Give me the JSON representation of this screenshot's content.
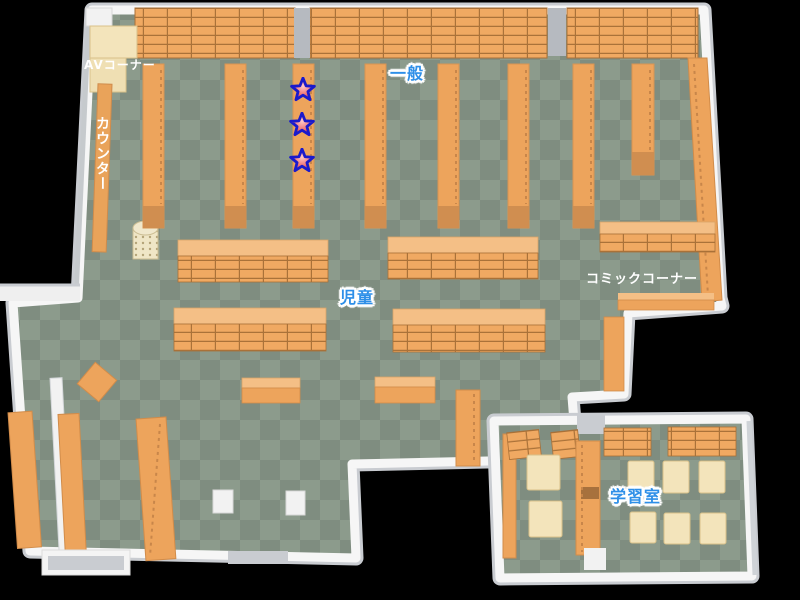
{
  "map": {
    "type": "library-floor-map",
    "areas": {
      "av_corner": {
        "label": "AVコーナー"
      },
      "counter": {
        "label": "カウンター"
      },
      "general": {
        "label": "一般"
      },
      "children": {
        "label": "児童"
      },
      "comic_corner": {
        "label": "コミックコーナー"
      },
      "study_room": {
        "label": "学習室"
      }
    },
    "markers": {
      "stars": [
        {
          "x": 303,
          "y": 90
        },
        {
          "x": 302,
          "y": 125
        },
        {
          "x": 302,
          "y": 161
        }
      ]
    },
    "colors": {
      "background": "#000000",
      "floor_light": "#8c9b8c",
      "floor_dark": "#7f8d80",
      "wall": "#f6f6f6",
      "wall_shadow": "#c9ccd1",
      "shelf": "#eda45c",
      "shelf_grid_line": "#aa7239",
      "shelf_top_band": "#f4bf86",
      "shelf_end_cap": "#d08e50",
      "cream_furniture": "#f3e4bb",
      "pillar_gray": "#b6bac0",
      "label_blue": "#2e8fe8",
      "star_outline": "#1a1acc",
      "star_fill": "#e33333"
    }
  }
}
